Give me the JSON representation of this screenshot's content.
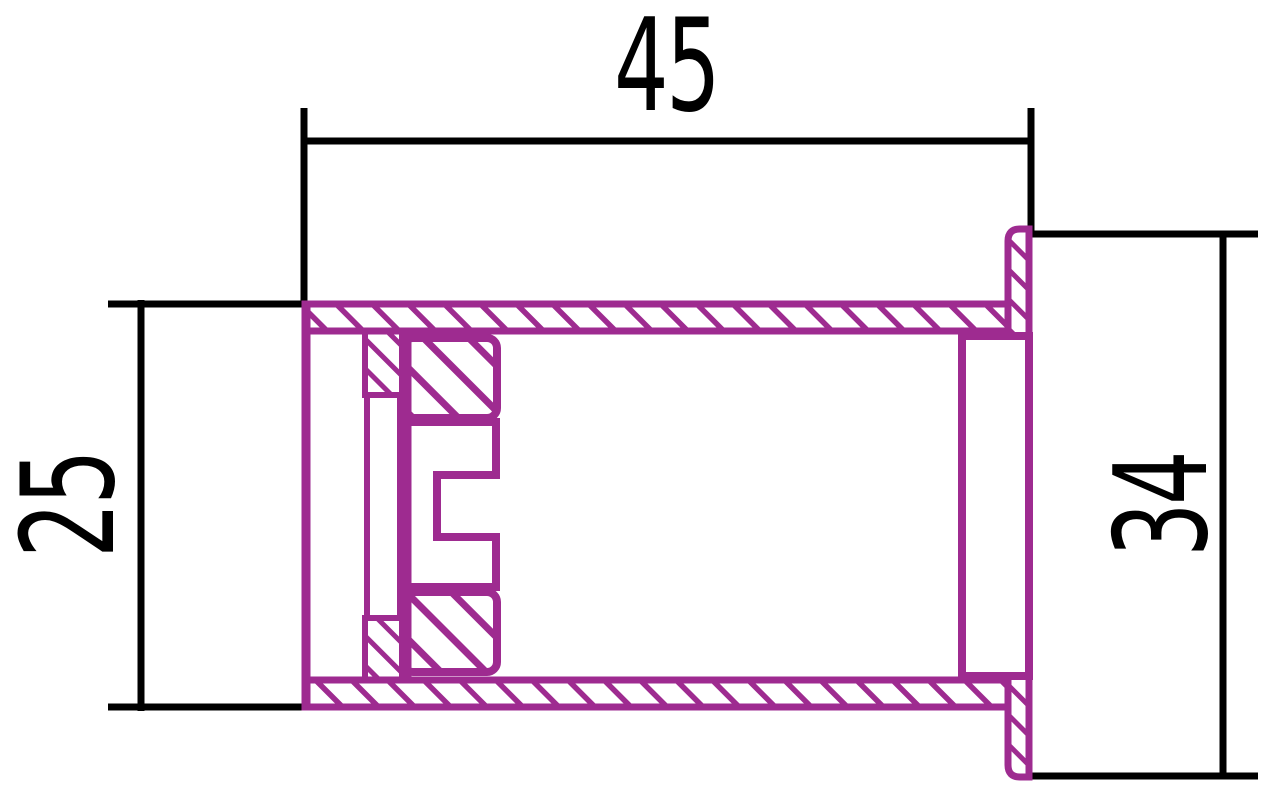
{
  "drawing": {
    "title": "fitting-cross-section",
    "type": "engineering-section-view",
    "dimensions": [
      {
        "id": "overall-length",
        "label": "45",
        "value": 45,
        "orientation": "horizontal",
        "position": "top"
      },
      {
        "id": "body-diameter",
        "label": "25",
        "value": 25,
        "orientation": "vertical",
        "position": "left"
      },
      {
        "id": "flange-diameter",
        "label": "34",
        "value": 34,
        "orientation": "vertical",
        "position": "right"
      }
    ],
    "colors": {
      "part_outline": "#9E2B90",
      "dimension_lines": "#000000",
      "background": "#FFFFFF"
    },
    "hatching": "diagonal-45deg"
  }
}
